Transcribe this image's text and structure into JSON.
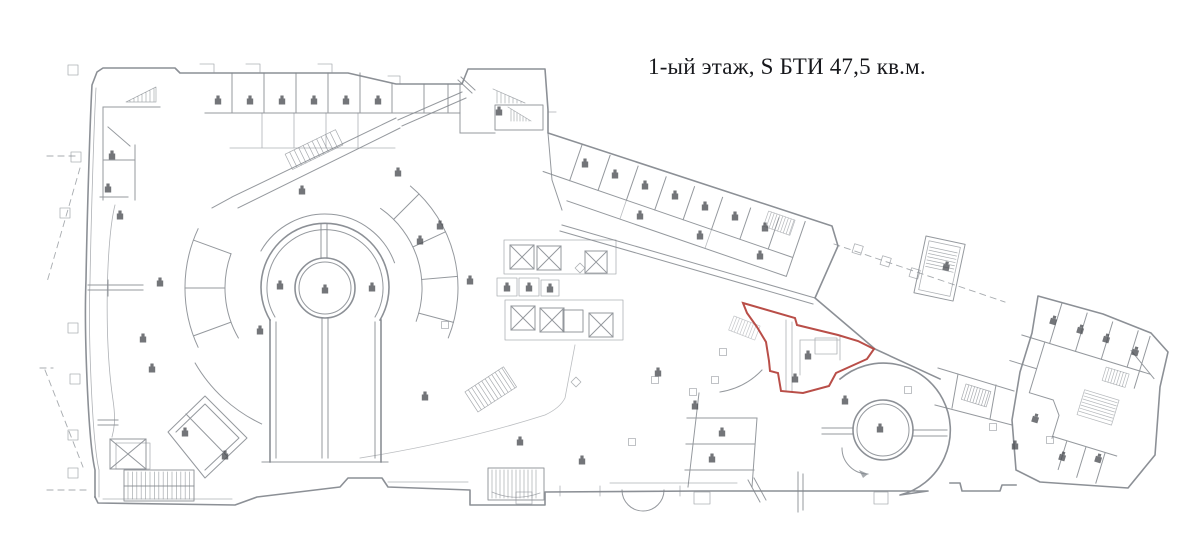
{
  "title": {
    "text": "1-ый этаж, S БТИ 47,5 кв.м."
  },
  "highlight": {
    "color": "#b5443e",
    "polygon_points": "743,303 795,318 797,325 838,335 858,341 874,349 867,359 836,373 829,386 803,393 781,391 778,373 770,371 769,361 766,342 757,327 747,313"
  },
  "plan": {
    "line_color": "#82878d",
    "glyph_color": "#4b4e53",
    "background": "#ffffff"
  }
}
